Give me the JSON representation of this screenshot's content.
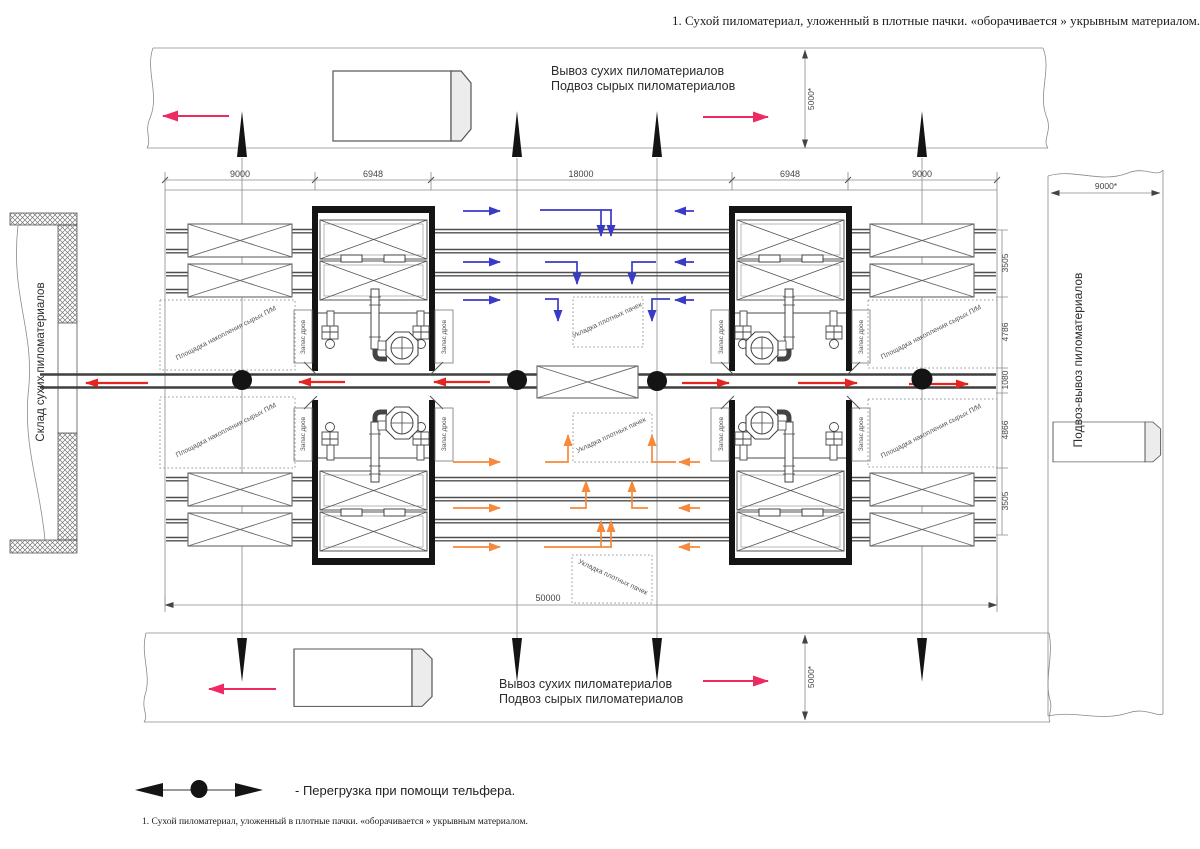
{
  "notes": {
    "header": "1. Сухой пиломатериал, уложенный в плотные пачки. «оборачивается » укрывным материалом.",
    "footer": "1. Сухой пиломатериал, уложенный в плотные пачки. «оборачивается » укрывным материалом."
  },
  "roads": {
    "top": {
      "line1": "Вывоз сухих пиломатериалов",
      "line2": "Подвоз сырых  пиломатериалов"
    },
    "bottom": {
      "line1": "Вывоз сухих пиломатериалов",
      "line2": "Подвоз сырых  пиломатериалов"
    },
    "right": {
      "label": "Подвоз-вывоз  пиломатериалов"
    }
  },
  "warehouse": {
    "label": "Склад сухих пиломатериалов"
  },
  "zones": {
    "accumulation": "Площадка накопления сырых  П/М",
    "firewood": "Запас дров",
    "stacking": "Укладка плотных пачек"
  },
  "dimensions": {
    "top": [
      "9000",
      "6948",
      "18000",
      "6948",
      "9000"
    ],
    "right_side": [
      "3505",
      "4786",
      "1080",
      "4866",
      "3505"
    ],
    "total_length": "50000",
    "road_width": "5000*",
    "right_road_width": "9000*"
  },
  "legend": {
    "telpher_note": "- Перегрузка при помощи тельфера."
  },
  "colors": {
    "dry_flow": "#e62420",
    "wet_flow_upper": "#3a3ac8",
    "wet_flow_lower": "#f58a3c",
    "road_flow": "#ee2a62"
  }
}
